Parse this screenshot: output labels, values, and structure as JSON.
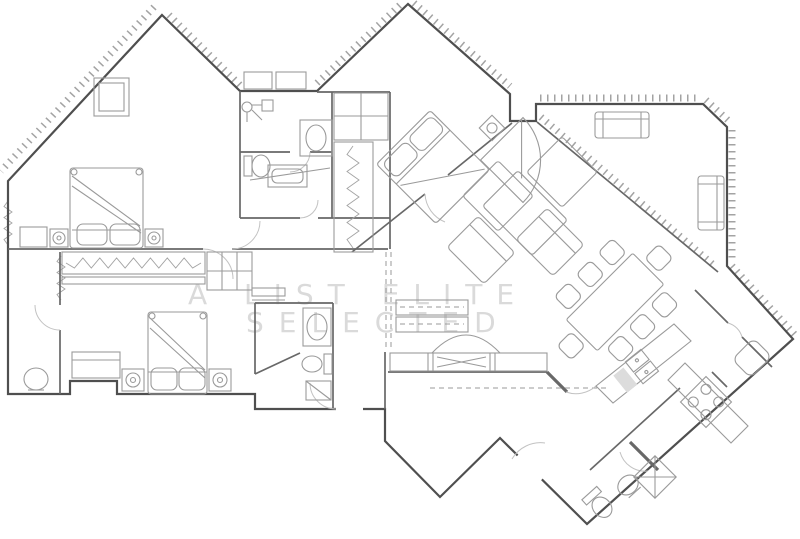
{
  "watermark": {
    "line1": "A LIST ELITE",
    "line2": "SELECTED"
  },
  "colors": {
    "background": "#ffffff",
    "wall": "#4f4f4f",
    "inwall": "#686868",
    "furn": "#9a9a9a",
    "door": "#c2c2c2",
    "hatch": "#a3a3a3",
    "watermark": "#dadada",
    "fillgray": "#dcdcdc"
  },
  "plan": {
    "type": "architectural-floor-plan"
  }
}
